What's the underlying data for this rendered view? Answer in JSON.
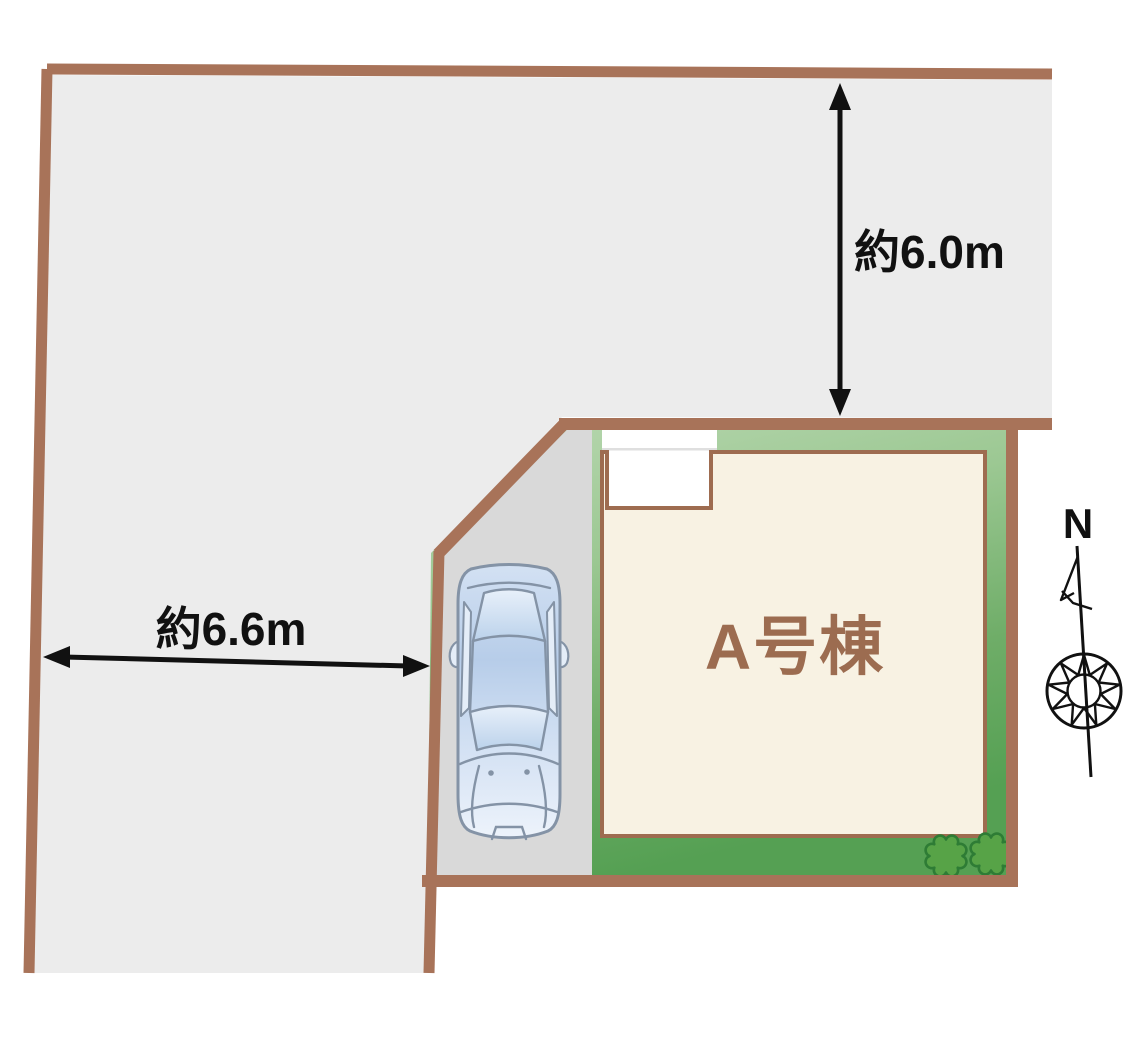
{
  "plan": {
    "building": {
      "label": "A号棟"
    },
    "dimensions": {
      "north": {
        "label": "約6.0m",
        "orientation": "vertical"
      },
      "west": {
        "label": "約6.6m",
        "orientation": "horizontal"
      }
    },
    "compass": {
      "north_label": "N"
    },
    "features": {
      "car": "parked-car-top-view",
      "bushes": 2,
      "entrance_porch": "white-notch-top-left-of-building"
    }
  },
  "colors": {
    "border-brown": "#A87359",
    "building-fill": "#F8F2E3",
    "building-stroke": "#9E6C50",
    "building-label": "#9C6C50",
    "road-gray": "#ECECEC",
    "parking-gray": "#D9D9D9",
    "green-light": "#B9D8B1",
    "green-mid": "#9CC893",
    "green-deep": "#6FAD68",
    "green-dark": "#55A053",
    "bush-fill": "#57A347",
    "bush-stroke": "#2E7C35",
    "porch-white": "#FFFFFF",
    "porch-line": "#DFDFDF",
    "ink": "#111111",
    "car-stroke": "#8493A6",
    "car-top": "#D3E1F3",
    "car-mid": "#B7CDE9",
    "car-lower": "#CCDCF1",
    "car-light": "#EDF3FB",
    "car-window": "#E4EDF8",
    "glass-top": "#E8F0FA",
    "glass-bottom": "#BBD2EB"
  }
}
